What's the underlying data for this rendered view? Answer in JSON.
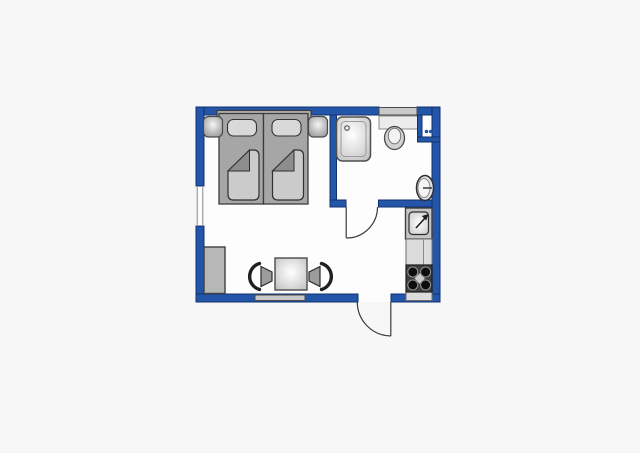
{
  "page": {
    "kind": "floor-plan-drawing",
    "visible_text": [],
    "rooms": [
      {
        "name": "sleeping-living-area"
      },
      {
        "name": "bathroom"
      },
      {
        "name": "kitchenette"
      }
    ],
    "elements": [
      "double-bed",
      "headboard",
      "pillow-left",
      "pillow-right",
      "duvet-left",
      "duvet-right",
      "nightstand-left",
      "nightstand-right",
      "wardrobe",
      "dining-table",
      "chair-left",
      "chair-right",
      "shower",
      "toilet",
      "washbasin",
      "bathroom-door",
      "entry-door",
      "kitchen-sink",
      "kitchen-counter",
      "stove-4-burners",
      "wall-niche-boiler",
      "window-left",
      "window-bottom",
      "window-top",
      "shelf-over-toilet"
    ]
  },
  "colors": {
    "bg": "#f7f7f8",
    "floor": "#fdfdfd",
    "wall": "#2355a8",
    "wall_edge": "#10316f",
    "window": "#c9c9c9",
    "outline": "#3a3a3a",
    "frame": "#a6a6a6",
    "panel": "#d9d9d9",
    "duvet": "#cbcbcb",
    "fold": "#8d8d8d",
    "dark": "#3f3f3f",
    "burner": "#0c0c0c",
    "counter": "#dcdcdc",
    "shelf": "#ececec",
    "seat": "#9c9c9c",
    "headboard": "#b4b4b4",
    "wardrobe": "#b7b7b7"
  }
}
